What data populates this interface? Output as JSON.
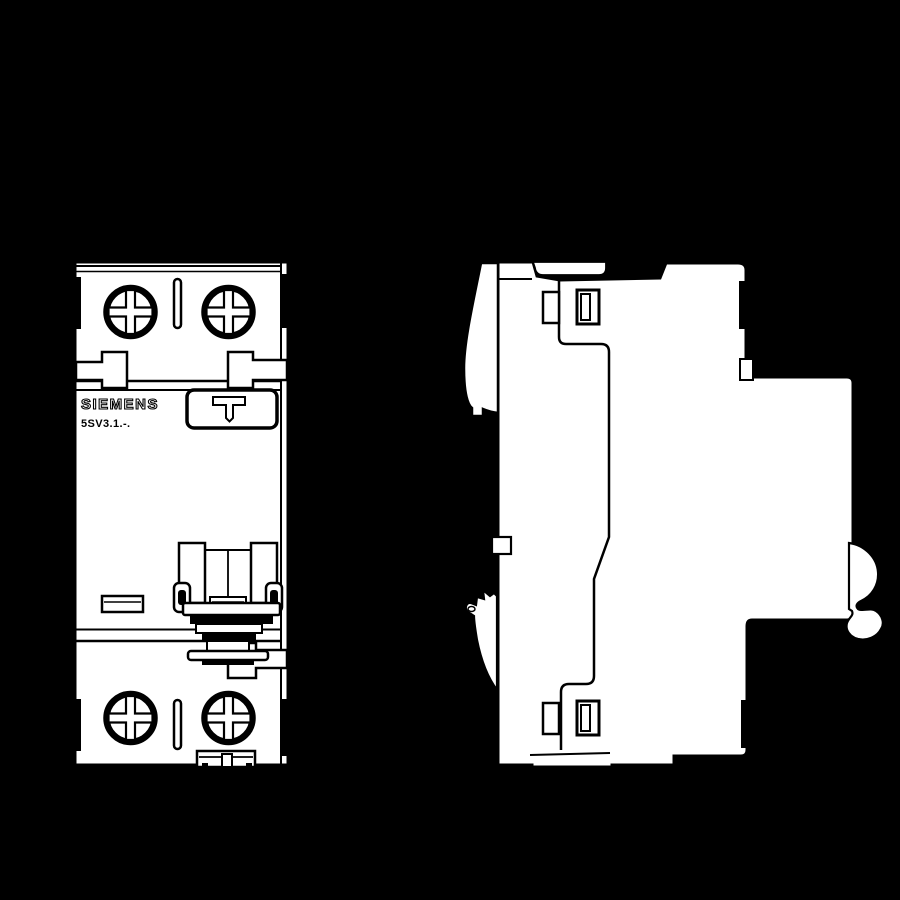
{
  "colors": {
    "background": "#000000",
    "housing_fill": "#ffffff",
    "line": "#000000"
  },
  "front_view": {
    "brand_label": "SIEMENS",
    "model_label": "5SV3.1.-."
  }
}
